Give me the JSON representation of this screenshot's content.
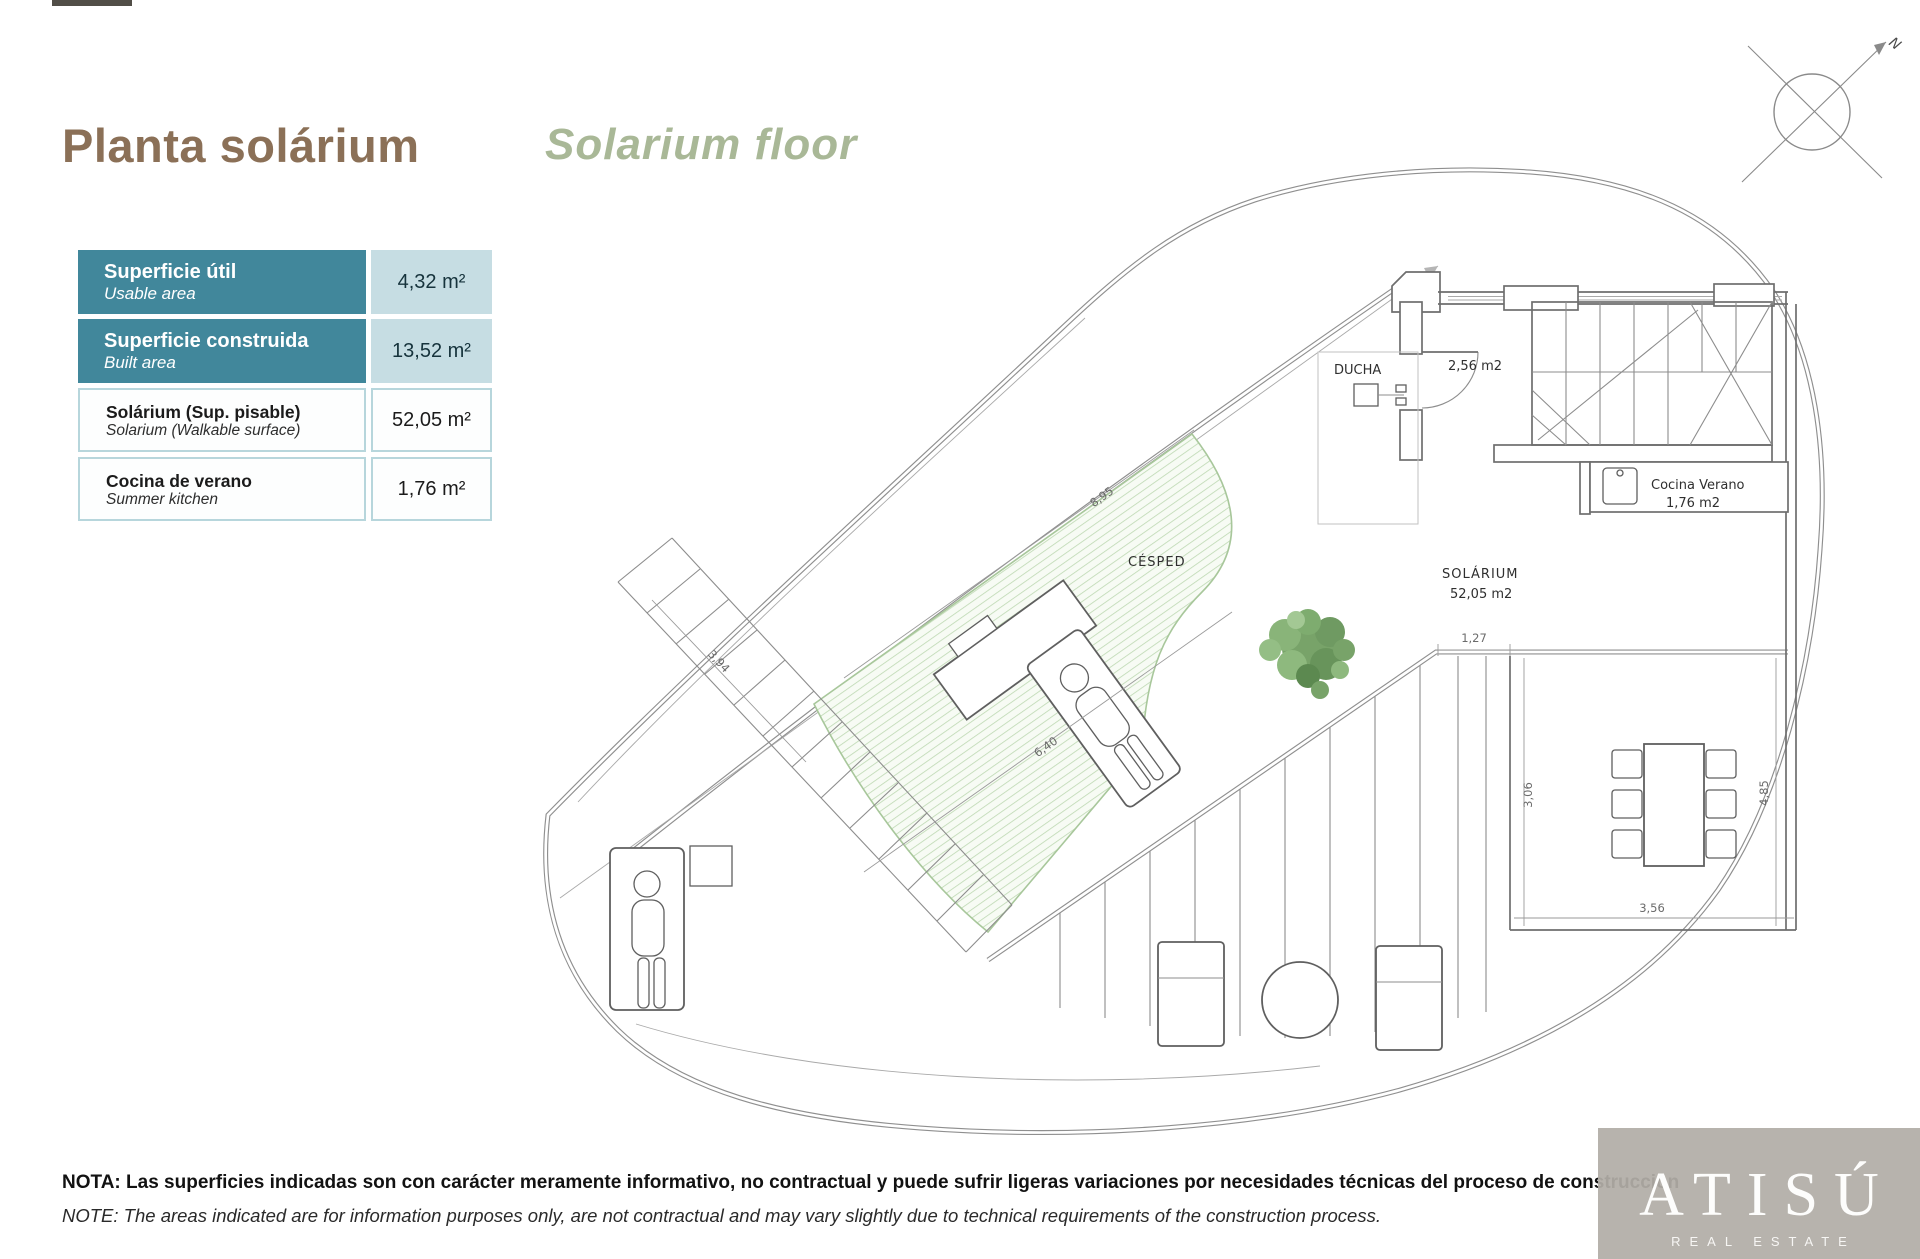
{
  "header": {
    "title_es": "Planta solárium",
    "title_en": "Solarium floor",
    "title_es_color": "#8b7057",
    "title_en_color": "#a9b897"
  },
  "area_table": {
    "teal_color": "#41879B",
    "light_value_bg": "#c6dde3",
    "border_color": "#b7d6dc",
    "rows": [
      {
        "label_es": "Superficie útil",
        "label_en": "Usable area",
        "value": "4,32 m²",
        "style": "teal"
      },
      {
        "label_es": "Superficie construida",
        "label_en": "Built area",
        "value": "13,52 m²",
        "style": "teal"
      },
      {
        "label_es": "Solárium (Sup. pisable)",
        "label_en": "Solarium (Walkable surface)",
        "value": "52,05 m²",
        "style": "light"
      },
      {
        "label_es": "Cocina de verano",
        "label_en": "Summer kitchen",
        "value": "1,76 m²",
        "style": "light"
      }
    ]
  },
  "plan": {
    "labels": {
      "ducha": "DUCHA",
      "room_area": "2,56 m2",
      "kitchen_line1": "Cocina Verano",
      "kitchen_line2": "1,76 m2",
      "solarium_line1": "SOLÁRIUM",
      "solarium_line2": "52,05 m2",
      "cesped": "CÉSPED",
      "north": "N"
    },
    "dimensions": {
      "d895": "8,95",
      "d127": "1,27",
      "d306": "3,06",
      "d485": "4,85",
      "d356": "3,56",
      "d640": "6,40",
      "d394": "3,94"
    },
    "grass_color": "#bdd8b2",
    "line_color": "#6e6e6e"
  },
  "footer": {
    "note_es": "NOTA: Las superficies indicadas son con carácter meramente informativo, no contractual y puede sufrir ligeras variaciones por necesidades técnicas del proceso de construcción",
    "note_en": "NOTE: The areas indicated are for information purposes only, are not contractual and may vary slightly due to technical requirements of the construction process."
  },
  "watermark": {
    "brand": "ATISÚ",
    "tagline": "REAL ESTATE"
  }
}
